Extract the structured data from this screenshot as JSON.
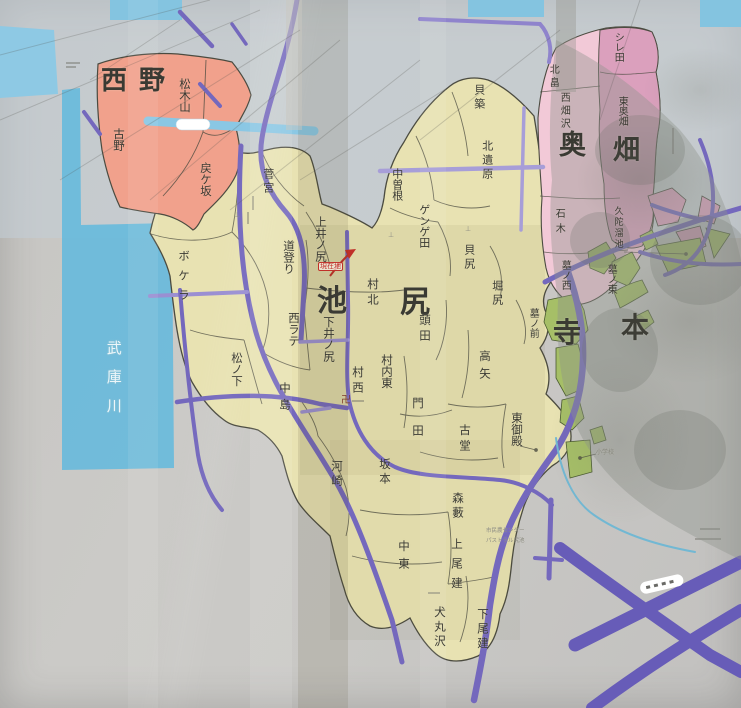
{
  "colors": {
    "photo_background": "#c9c8c5",
    "sky_reflection": "#c5cfd9",
    "river_blue": "#6cbadb",
    "district_beige": "#e8e2b2",
    "district_salmon": "#f1a18c",
    "district_pink_light": "#f2c9d7",
    "district_pink_dark": "#dba0bd",
    "district_green": "#a6bf67",
    "road_purple": "#7468bd",
    "road_lavender": "#a79ed8",
    "road_wide_purple": "#675cb8",
    "road_cyan": "#8ac7e4",
    "stream_blue": "#72b8d3",
    "boundary_ink": "#4b4b40",
    "label_ink": "#3a3a33",
    "marker_red": "#c03028"
  },
  "map": {
    "marker": {
      "current_location": "現在地"
    },
    "labels": [
      {
        "t": "西野",
        "x": 101,
        "y": 68,
        "s": 26,
        "b": 1,
        "ls": 12,
        "k": "area"
      },
      {
        "t": "奥",
        "x": 559,
        "y": 132,
        "s": 27,
        "b": 1,
        "k": "area"
      },
      {
        "t": "畑",
        "x": 613,
        "y": 137,
        "s": 27,
        "b": 1,
        "k": "area"
      },
      {
        "t": "池",
        "x": 317,
        "y": 286,
        "s": 30,
        "b": 1,
        "k": "area"
      },
      {
        "t": "尻",
        "x": 400,
        "y": 287,
        "s": 30,
        "b": 1,
        "k": "area"
      },
      {
        "t": "寺",
        "x": 553,
        "y": 318,
        "s": 28,
        "b": 1,
        "k": "area"
      },
      {
        "t": "本",
        "x": 621,
        "y": 313,
        "s": 28,
        "b": 1,
        "k": "area"
      },
      {
        "t": "武庫川",
        "x": 113,
        "y": 340,
        "s": 15,
        "v": 1,
        "ls": 14,
        "c": "white",
        "k": "river"
      },
      {
        "t": "松木山",
        "x": 184,
        "y": 78,
        "s": 11.5,
        "v": 1
      },
      {
        "t": "古野",
        "x": 118,
        "y": 128,
        "s": 11.5,
        "v": 1
      },
      {
        "t": "戻ケ坂",
        "x": 205,
        "y": 162,
        "s": 11.5,
        "v": 1
      },
      {
        "t": "菅宮",
        "x": 268,
        "y": 168,
        "s": 11,
        "v": 1,
        "ls": 3
      },
      {
        "t": "上井ノ尻",
        "x": 320,
        "y": 216,
        "s": 11.5,
        "v": 1
      },
      {
        "t": "道登り",
        "x": 288,
        "y": 240,
        "s": 11.5,
        "v": 1
      },
      {
        "t": "ボケラ",
        "x": 183,
        "y": 250,
        "s": 11.5,
        "v": 1,
        "ls": 8
      },
      {
        "t": "西ラテ",
        "x": 293,
        "y": 312,
        "s": 11.5,
        "v": 1
      },
      {
        "t": "下井ノ尻",
        "x": 328,
        "y": 316,
        "s": 11.5,
        "v": 1
      },
      {
        "t": "松ノ下",
        "x": 236,
        "y": 352,
        "s": 11.5,
        "v": 1
      },
      {
        "t": "中島",
        "x": 284,
        "y": 382,
        "s": 11.5,
        "v": 1,
        "ls": 5
      },
      {
        "t": "村北",
        "x": 372,
        "y": 278,
        "s": 11.5,
        "v": 1,
        "ls": 4
      },
      {
        "t": "村西",
        "x": 357,
        "y": 366,
        "s": 11.5,
        "v": 1,
        "ls": 4
      },
      {
        "t": "村内東",
        "x": 386,
        "y": 354,
        "s": 11.5,
        "v": 1
      },
      {
        "t": "頭田",
        "x": 424,
        "y": 314,
        "s": 11.5,
        "v": 1,
        "ls": 4
      },
      {
        "t": "門田",
        "x": 417,
        "y": 397,
        "s": 11.5,
        "v": 1,
        "ls": 16
      },
      {
        "t": "高矢",
        "x": 484,
        "y": 350,
        "s": 11.5,
        "v": 1,
        "ls": 6
      },
      {
        "t": "古堂",
        "x": 464,
        "y": 424,
        "s": 11.5,
        "v": 1,
        "ls": 4
      },
      {
        "t": "東御殿",
        "x": 516,
        "y": 412,
        "s": 11.5,
        "v": 1
      },
      {
        "t": "河崎",
        "x": 336,
        "y": 460,
        "s": 11.5,
        "v": 1,
        "ls": 3
      },
      {
        "t": "坂本",
        "x": 384,
        "y": 458,
        "s": 11.5,
        "v": 1,
        "ls": 3
      },
      {
        "t": "森藪",
        "x": 457,
        "y": 492,
        "s": 11.5,
        "v": 1,
        "ls": 3
      },
      {
        "t": "中東",
        "x": 403,
        "y": 540,
        "s": 11.5,
        "v": 1,
        "ls": 6
      },
      {
        "t": "上尾建",
        "x": 456,
        "y": 538,
        "s": 11.5,
        "v": 1,
        "ls": 8
      },
      {
        "t": "犬丸沢",
        "x": 439,
        "y": 606,
        "s": 11.5,
        "v": 1,
        "ls": 3
      },
      {
        "t": "下尾建",
        "x": 482,
        "y": 608,
        "s": 11.5,
        "v": 1,
        "ls": 3
      },
      {
        "t": "貝築",
        "x": 479,
        "y": 84,
        "s": 11,
        "v": 1,
        "ls": 3
      },
      {
        "t": "北遺原",
        "x": 487,
        "y": 140,
        "s": 11,
        "v": 1,
        "ls": 3
      },
      {
        "t": "中曽根",
        "x": 397,
        "y": 168,
        "s": 11,
        "v": 1
      },
      {
        "t": "ゲンゲ田",
        "x": 424,
        "y": 204,
        "s": 11,
        "v": 1
      },
      {
        "t": "貝尻",
        "x": 469,
        "y": 244,
        "s": 11,
        "v": 1,
        "ls": 3
      },
      {
        "t": "堀尻",
        "x": 497,
        "y": 280,
        "s": 11,
        "v": 1,
        "ls": 3
      },
      {
        "t": "墓ノ前",
        "x": 532,
        "y": 308,
        "s": 10,
        "v": 1
      },
      {
        "t": "石木",
        "x": 558,
        "y": 208,
        "s": 10,
        "v": 1,
        "ls": 5
      },
      {
        "t": "久陀溜池",
        "x": 617,
        "y": 206,
        "s": 9,
        "v": 1,
        "ls": 2
      },
      {
        "t": "墓ノ西",
        "x": 564,
        "y": 260,
        "s": 10,
        "v": 1
      },
      {
        "t": "墓ノ東",
        "x": 610,
        "y": 264,
        "s": 10,
        "v": 1
      },
      {
        "t": "北畠",
        "x": 552,
        "y": 64,
        "s": 10,
        "v": 1,
        "ls": 3
      },
      {
        "t": "シレ田",
        "x": 617,
        "y": 32,
        "s": 10,
        "v": 1
      },
      {
        "t": "東奥畑",
        "x": 621,
        "y": 96,
        "s": 10,
        "v": 1
      },
      {
        "t": "西畑沢",
        "x": 563,
        "y": 92,
        "s": 10,
        "v": 1,
        "ls": 3
      },
      {
        "t": "現在地",
        "x": 318,
        "y": 262,
        "s": 7,
        "c": "red",
        "k": "marker"
      },
      {
        "t": "卍",
        "x": 341,
        "y": 396,
        "s": 10,
        "c": "temple",
        "k": "symbol"
      },
      {
        "t": "⊥",
        "x": 234,
        "y": 212,
        "s": 7,
        "c": "gray",
        "k": "symbol"
      },
      {
        "t": "⊥",
        "x": 388,
        "y": 232,
        "s": 7,
        "c": "gray",
        "k": "symbol"
      },
      {
        "t": "⊥",
        "x": 465,
        "y": 226,
        "s": 7,
        "c": "gray",
        "k": "symbol"
      },
      {
        "t": "小学校",
        "x": 596,
        "y": 450,
        "s": 6,
        "c": "gray",
        "k": "facility"
      },
      {
        "t": "市民農センター",
        "x": 486,
        "y": 529,
        "s": 5.5,
        "c": "gray",
        "k": "facility"
      },
      {
        "t": "パストラル尻池",
        "x": 486,
        "y": 539,
        "s": 5.5,
        "c": "gray",
        "k": "facility"
      }
    ]
  }
}
